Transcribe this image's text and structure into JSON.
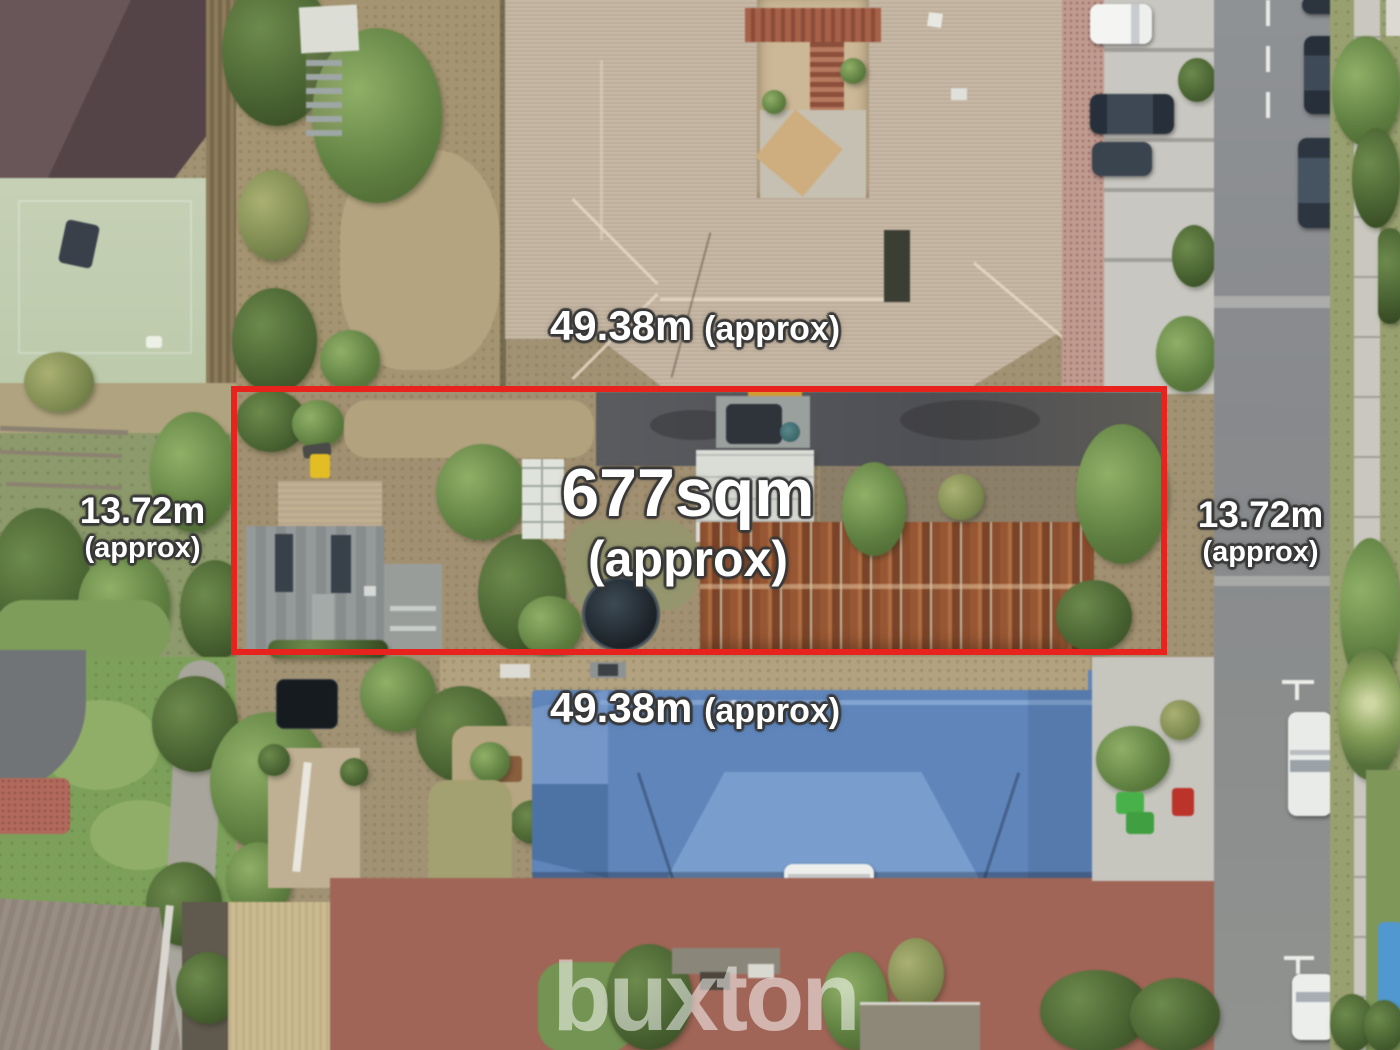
{
  "annotations": {
    "area": {
      "value": "677sqm",
      "qualifier": "(approx)"
    },
    "width_top": {
      "value": "49.38m",
      "qualifier": "(approx)"
    },
    "width_bottom": {
      "value": "49.38m",
      "qualifier": "(approx)"
    },
    "depth_left": {
      "value": "13.72m",
      "qualifier": "(approx)"
    },
    "depth_right": {
      "value": "13.72m",
      "qualifier": "(approx)"
    },
    "boundary_color": "#e8231d",
    "label_color": "#ffffff"
  },
  "watermark": {
    "brand": "buxton",
    "color": "rgba(255,255,255,0.52)"
  }
}
